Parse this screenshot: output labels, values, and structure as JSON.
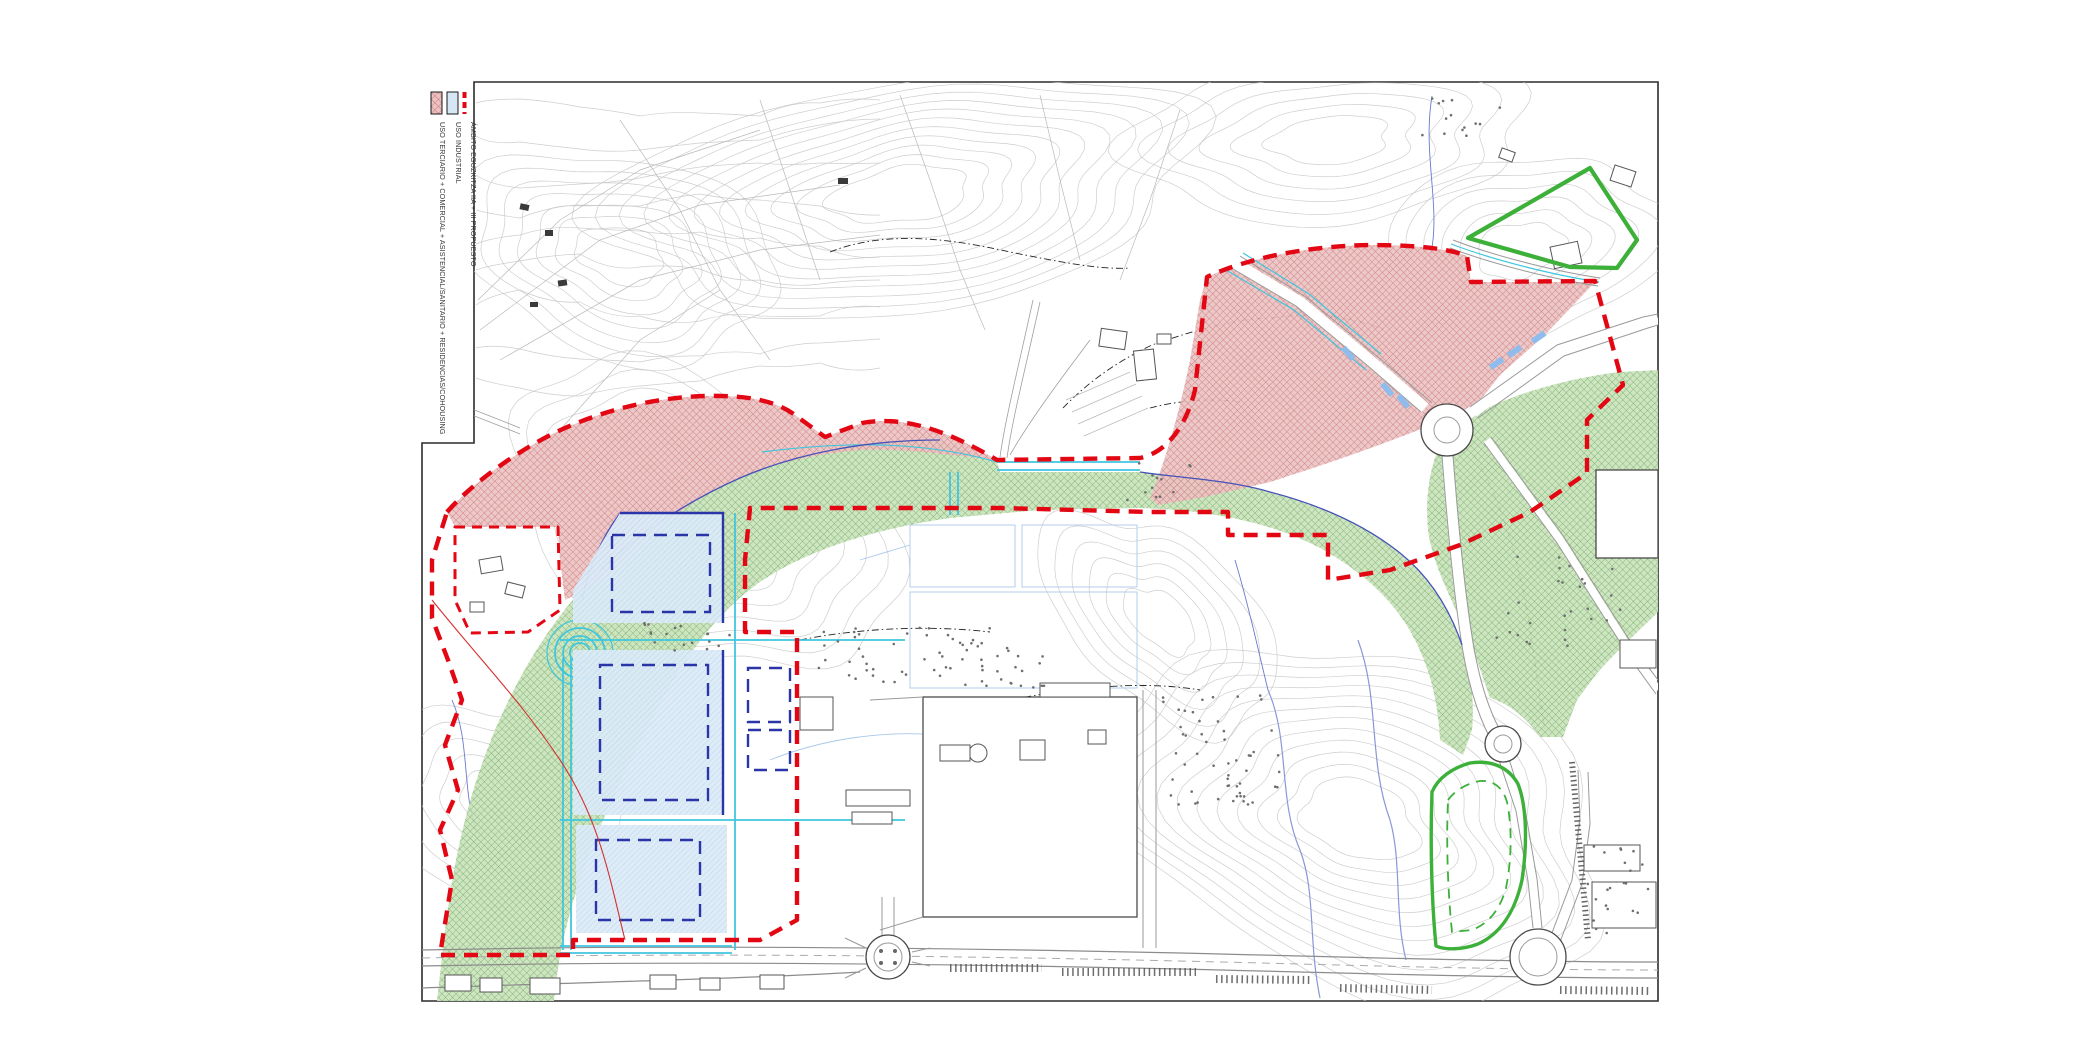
{
  "document": {
    "type": "urban-planning-plano",
    "sheet": "topographic site plan with proposal overlay"
  },
  "legend": {
    "items": [
      {
        "id": "uso-terciario",
        "label": "USO TERCIARIO + COMERCIAL + ASISTENCIAL/SANITARIO + RESIDENCIAS/COHOUSING",
        "swatch": "red-crosshatch-box"
      },
      {
        "id": "uso-industrial",
        "label": "USO INDUSTRIAL",
        "swatch": "light-blue-box"
      },
      {
        "id": "ambito",
        "label": "ÁMBITO EGUZKITZA IIA + III PROPUESTO",
        "swatch": "red-dashed-line"
      }
    ]
  },
  "colors": {
    "red": "#e30613",
    "pink_bg": "#eac3c3",
    "pink_line": "#cf7b7b",
    "green_bg": "#cbe3bd",
    "green_line": "#6fae60",
    "green_stroke": "#3db03a",
    "blue_bg": "#dcebf7",
    "blue_line": "#aecbe8",
    "navy": "#2a35a8",
    "cyan": "#3fc6de",
    "contour": "#c6c6c6",
    "road": "#9a9a9a",
    "building": "#4a4a4a",
    "stream": "#8a96d8",
    "legend_blue_swatch": "#d6e6f4"
  }
}
